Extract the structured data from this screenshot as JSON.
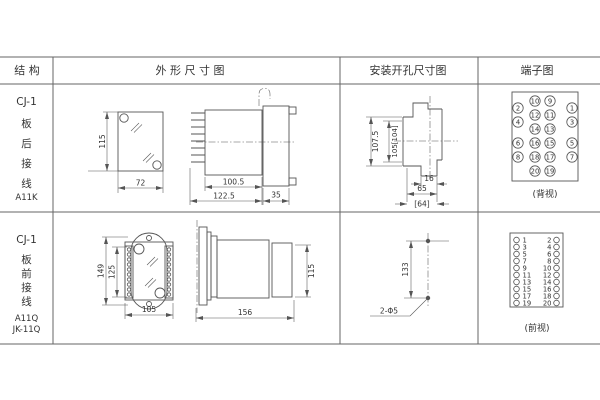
{
  "header": {
    "col_structure": "结 构",
    "col_outline": "外 形 尺 寸 图",
    "col_mounting": "安装开孔尺寸图",
    "col_terminal": "端子图"
  },
  "rows": [
    {
      "model": "CJ-1",
      "mounting_type": "板后接线",
      "variant": "A11K",
      "outline": {
        "front": {
          "height": "115",
          "width": "72"
        },
        "side": {
          "body_depth": "100.5",
          "total_depth": "122.5",
          "rear_depth": "35"
        }
      },
      "mounting": {
        "height_outer": "107.5",
        "height_inner": "105[104]",
        "slot_width": "16",
        "width": "65",
        "width_alt": "[64]"
      },
      "terminal": {
        "caption": "(背视)",
        "mid_left": [
          10,
          12,
          14,
          16,
          18,
          20
        ],
        "mid_right": [
          9,
          11,
          13,
          15,
          17,
          19
        ],
        "outer_left": [
          2,
          4,
          6,
          8
        ],
        "outer_right": [
          1,
          3,
          5,
          7
        ]
      }
    },
    {
      "model": "CJ-1",
      "mounting_type": "板前接线",
      "variant": "A11Q",
      "variant2": "JK-11Q",
      "outline": {
        "front": {
          "height_outer": "149",
          "height_inner": "125",
          "width": "105"
        },
        "side": {
          "total_depth": "156",
          "height": "115"
        }
      },
      "mounting": {
        "hole_spacing": "133",
        "holes": "2-Φ5"
      },
      "terminal": {
        "caption": "(前视)",
        "left": [
          1,
          3,
          5,
          7,
          9,
          11,
          13,
          15,
          17,
          19
        ],
        "right": [
          2,
          4,
          6,
          8,
          10,
          12,
          14,
          16,
          18,
          20
        ]
      }
    }
  ]
}
